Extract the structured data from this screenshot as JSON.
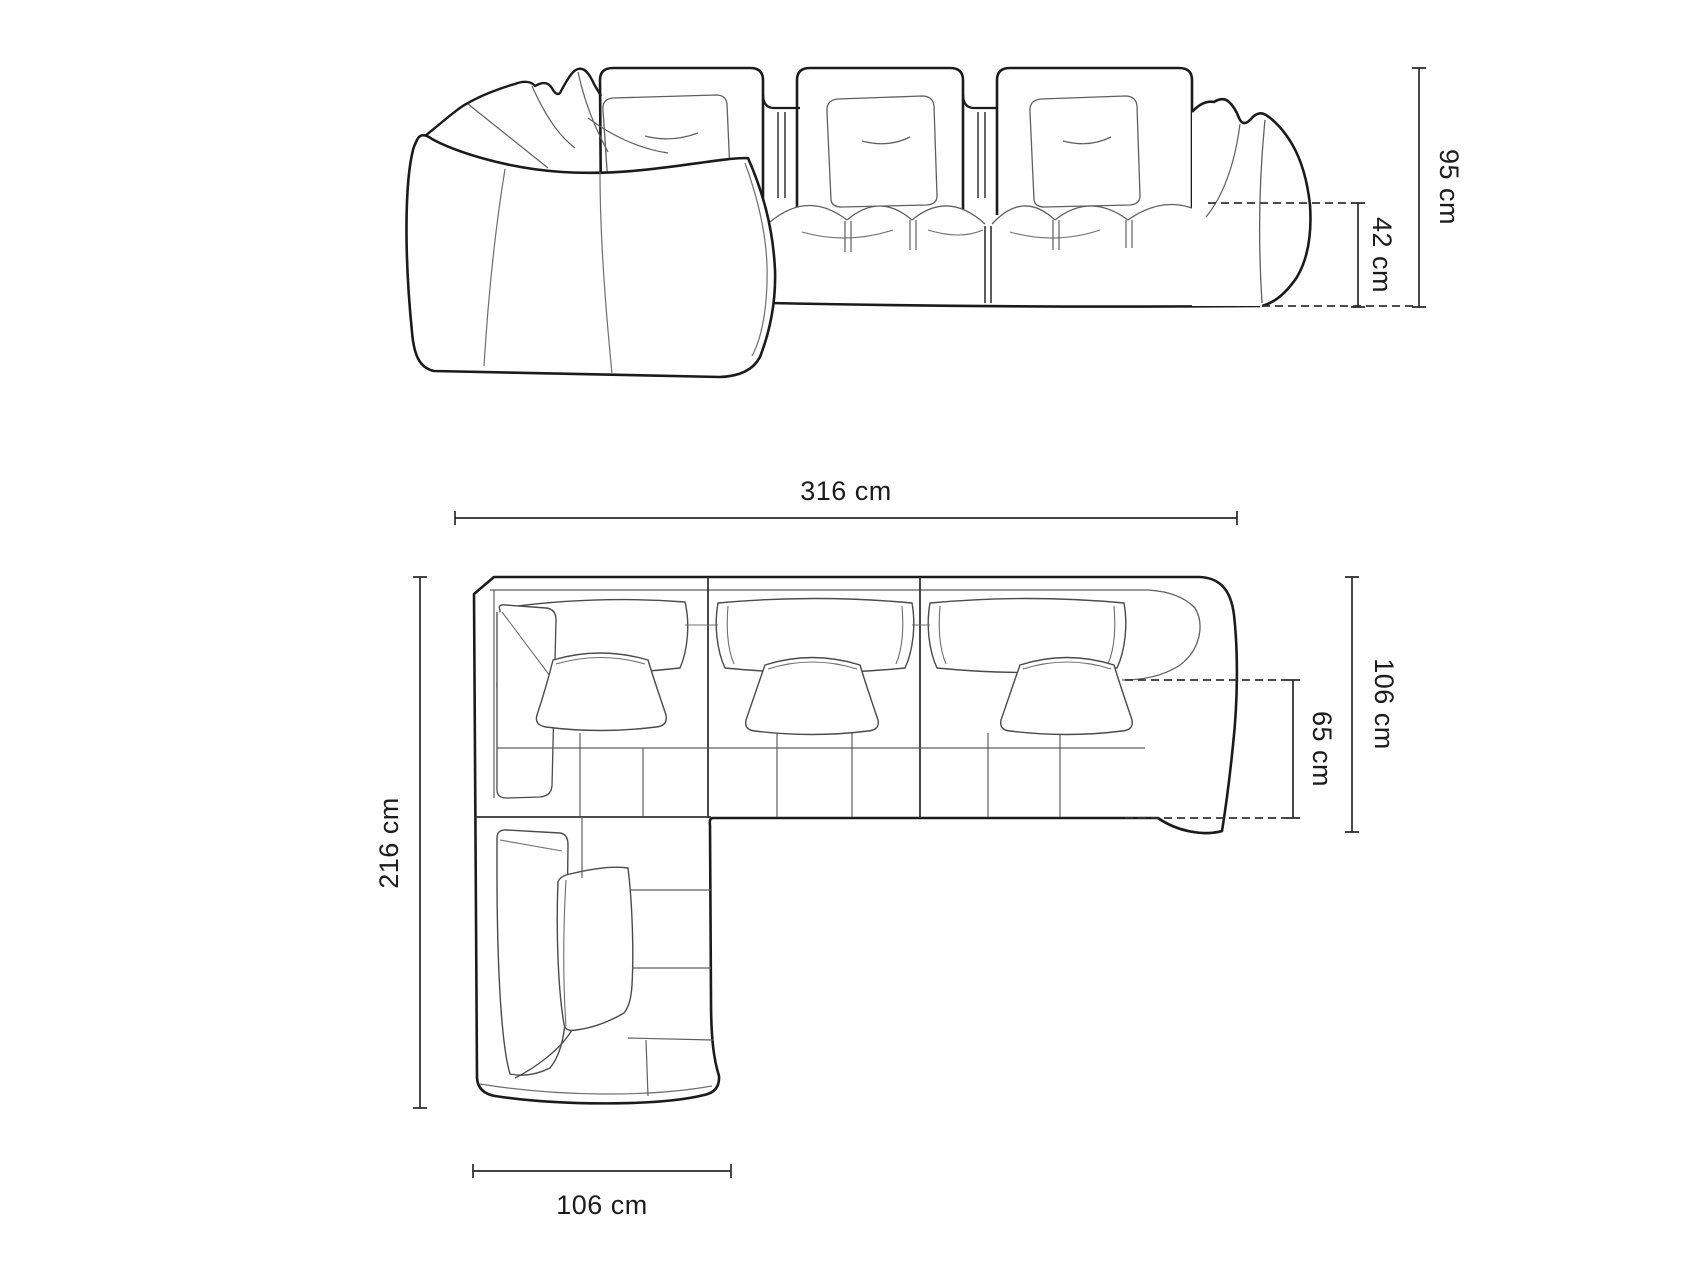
{
  "page": {
    "background": "#ffffff",
    "subject": "Technical dimension drawing of a modular corner sofa",
    "views": {
      "front_elevation": {
        "name": "front-view",
        "position": "top"
      },
      "top_plan": {
        "name": "plan-view",
        "position": "bottom"
      }
    }
  },
  "style": {
    "outline_color": "#1b1b1b",
    "seam_color": "#333333",
    "thin_line_color": "#5f5f5f",
    "dimension_line_color": "#2b2b2b",
    "text_color": "#1c1c1c"
  },
  "dimensions": {
    "total_height": {
      "label": "95 cm",
      "value": 95,
      "unit": "cm",
      "view": "front elevation",
      "measures": "overall height",
      "side": "right",
      "orientation": "vertical"
    },
    "seat_height": {
      "label": "42 cm",
      "value": 42,
      "unit": "cm",
      "view": "front elevation",
      "measures": "seat height",
      "side": "right",
      "orientation": "vertical"
    },
    "total_width": {
      "label": "316 cm",
      "value": 316,
      "unit": "cm",
      "view": "top plan",
      "measures": "overall width",
      "side": "top",
      "orientation": "horizontal"
    },
    "total_depth": {
      "label": "106 cm",
      "value": 106,
      "unit": "cm",
      "view": "top plan",
      "measures": "overall depth",
      "side": "right",
      "orientation": "vertical"
    },
    "seat_depth": {
      "label": "65 cm",
      "value": 65,
      "unit": "cm",
      "view": "top plan",
      "measures": "seat depth",
      "side": "right",
      "orientation": "vertical"
    },
    "chaise_length": {
      "label": "216 cm",
      "value": 216,
      "unit": "cm",
      "view": "top plan",
      "measures": "corner / chaise length",
      "side": "left",
      "orientation": "vertical"
    },
    "chaise_width": {
      "label": "106 cm",
      "value": 106,
      "unit": "cm",
      "view": "top plan",
      "measures": "corner / chaise width",
      "side": "bottom",
      "orientation": "horizontal"
    }
  }
}
